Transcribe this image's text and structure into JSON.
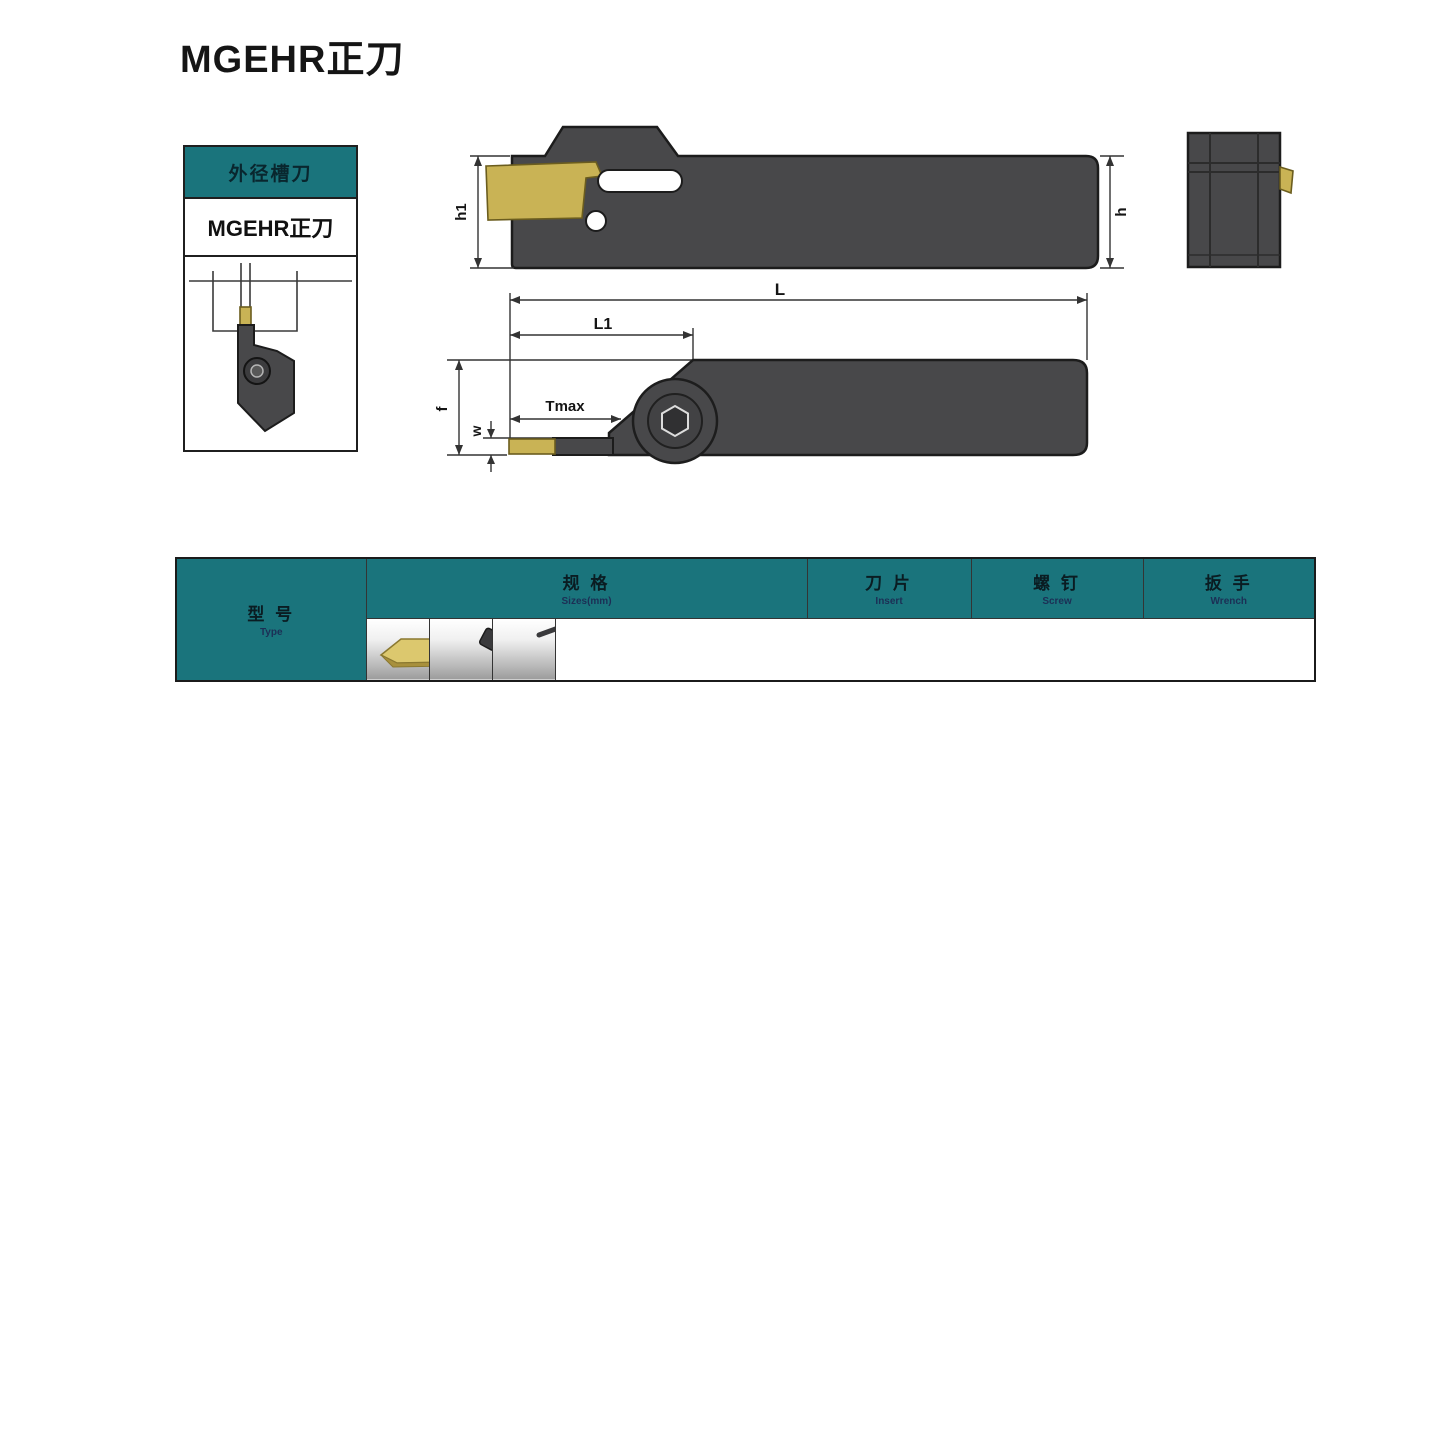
{
  "page": {
    "title": "MGEHR正刀"
  },
  "side_panel": {
    "category": "外径槽刀",
    "model": "MGEHR正刀"
  },
  "dimensions": {
    "h1": "h1",
    "h": "h",
    "L": "L",
    "L1": "L1",
    "Tmax": "Tmax",
    "f": "f",
    "w": "w"
  },
  "table": {
    "header": {
      "type_zh": "型 号",
      "type_en": "Type",
      "spec_zh": "规 格",
      "spec_en": "Sizes(mm)",
      "spec_cols": [
        "W",
        "b",
        "h",
        "L",
        "h1",
        "f",
        "Tmax"
      ],
      "insert_zh": "刀 片",
      "insert_en": "Insert",
      "screw_zh": "螺 钉",
      "screw_en": "Screw",
      "wrench_zh": "扳 手",
      "wrench_en": "Wrench"
    },
    "rows": [
      [
        "MGEHR1616-1.5",
        "1.5",
        "16",
        "16",
        "110",
        "16",
        "16",
        "8"
      ],
      [
        "MGEHR2020-1.5",
        "1.5",
        "20",
        "20",
        "125",
        "20",
        "20",
        "8"
      ],
      [
        "MGEHR2525-1.5",
        "1.5",
        "25",
        "25",
        "125",
        "20",
        "20",
        "10"
      ],
      [
        "MGEHR1212-2",
        "2",
        "12",
        "12",
        "100",
        "12",
        "12",
        "10"
      ],
      [
        "MGEHR1616-2",
        "2",
        "16",
        "16",
        "110",
        "16",
        "16",
        "14"
      ],
      [
        "MGEHR2020-2",
        "2",
        "20",
        "20",
        "125",
        "20",
        "20",
        "12"
      ],
      [
        "MGEHR1616-2.5",
        "2.5",
        "16",
        "16",
        "110",
        "16",
        "16",
        "14"
      ],
      [
        "MGEHR2020-2.5",
        "2.5",
        "20",
        "20",
        "125",
        "20",
        "20",
        "15"
      ],
      [
        "MGEHR2525-2.5",
        "2.5",
        "25",
        "25",
        "150",
        "25",
        "25",
        "15"
      ],
      [
        "MGEHR1212-3",
        "3",
        "12",
        "12",
        "100",
        "12",
        "12",
        "8"
      ],
      [
        "MGEHR1616-3",
        "3",
        "16",
        "16",
        "110",
        "16",
        "16",
        "17"
      ],
      [
        "MGEHR2020-3",
        "3",
        "20",
        "20",
        "125",
        "20",
        "20",
        "17"
      ],
      [
        "MGEHR2525-3",
        "3",
        "25",
        "25",
        "150",
        "25",
        "25",
        "17"
      ],
      [
        "MGEHR3232-3",
        "3",
        "32",
        "32",
        "170",
        "32",
        "32",
        "16"
      ],
      [
        "MGEHR1616-4",
        "4",
        "16",
        "16",
        "110",
        "16",
        "16",
        "14"
      ],
      [
        "MGEHR2020-4",
        "4",
        "20",
        "20",
        "125",
        "20",
        "20",
        "17"
      ],
      [
        "MGEHR2525-4",
        "4",
        "25",
        "25",
        "150",
        "25",
        "25",
        "17"
      ],
      [
        "MGEHR3232-4",
        "4",
        "32",
        "32",
        "170",
        "32",
        "32",
        "17"
      ],
      [
        "MGEHR2020-5",
        "5",
        "20",
        "20",
        "125",
        "20",
        "20",
        "21"
      ],
      [
        "MGEHR2525-5",
        "5",
        "25",
        "25",
        "150",
        "25",
        "25",
        "21"
      ],
      [
        "MGEHR3232-5",
        "5",
        "32",
        "32",
        "170",
        "32",
        "32",
        "23"
      ],
      [
        "MGEHR2525-6",
        "6",
        "25",
        "25",
        "150",
        "25",
        "25",
        "25"
      ],
      [
        "MGEHR3232-6",
        "6",
        "32",
        "32",
        "170",
        "32",
        "32",
        "25"
      ]
    ],
    "insert_merges": [
      {
        "start": 0,
        "span": 3,
        "lines": [
          "MGMN150"
        ]
      },
      {
        "start": 3,
        "span": 3,
        "lines": [
          "MGMN200",
          "MGGN200",
          "MRMN200"
        ]
      },
      {
        "start": 6,
        "span": 3,
        "lines": [
          "MGMN250",
          "MGGN250",
          "MRMN250"
        ]
      },
      {
        "start": 9,
        "span": 5,
        "lines": [
          "MGMN300",
          "MGGN300",
          "MRMN300"
        ]
      },
      {
        "start": 14,
        "span": 4,
        "lines": [
          "MGMN400",
          "MGGN400",
          "MRMN400"
        ]
      },
      {
        "start": 18,
        "span": 3,
        "lines": [
          "MGMN500",
          "MGGN500",
          "MRMN500"
        ]
      },
      {
        "start": 21,
        "span": 2,
        "lines": [
          "MGMN600",
          "MGGN600",
          "MRMN600"
        ]
      }
    ],
    "screw_merges": [
      {
        "start": 0,
        "span": 1,
        "text": "M5x18"
      },
      {
        "start": 1,
        "span": 1,
        "text": "M6x18"
      },
      {
        "start": 2,
        "span": 1,
        "text": "M5x18"
      },
      {
        "start": 3,
        "span": 2,
        "text": "M5x18"
      },
      {
        "start": 5,
        "span": 1,
        "text": "M6x18"
      },
      {
        "start": 6,
        "span": 3,
        "text": "M5x18"
      },
      {
        "start": 9,
        "span": 4,
        "text": "M5x18"
      },
      {
        "start": 13,
        "span": 1,
        "text": "M6x18"
      },
      {
        "start": 14,
        "span": 2,
        "text": "M5x18"
      },
      {
        "start": 16,
        "span": 2,
        "text": "M6x18"
      },
      {
        "start": 18,
        "span": 3,
        "text": "M6x18"
      },
      {
        "start": 21,
        "span": 2,
        "text": "M6x18"
      }
    ],
    "wrench_merges": [
      {
        "start": 0,
        "span": 1,
        "text": "L4"
      },
      {
        "start": 1,
        "span": 1,
        "text": "L5"
      },
      {
        "start": 2,
        "span": 1,
        "text": "L4"
      },
      {
        "start": 3,
        "span": 2,
        "text": "L4"
      },
      {
        "start": 5,
        "span": 1,
        "text": "L5"
      },
      {
        "start": 6,
        "span": 3,
        "text": "L4"
      },
      {
        "start": 9,
        "span": 4,
        "text": "L4"
      },
      {
        "start": 13,
        "span": 1,
        "text": "L5"
      },
      {
        "start": 14,
        "span": 2,
        "text": "L4"
      },
      {
        "start": 16,
        "span": 2,
        "text": "L5"
      },
      {
        "start": 18,
        "span": 3,
        "text": "L5"
      },
      {
        "start": 21,
        "span": 2,
        "text": "L5"
      }
    ],
    "group_ends": [
      2,
      5,
      8,
      13,
      17,
      20
    ]
  },
  "colors": {
    "teal": "#1a747c",
    "tool_gray": "#48484a",
    "insert_gold": "#c9b355"
  }
}
